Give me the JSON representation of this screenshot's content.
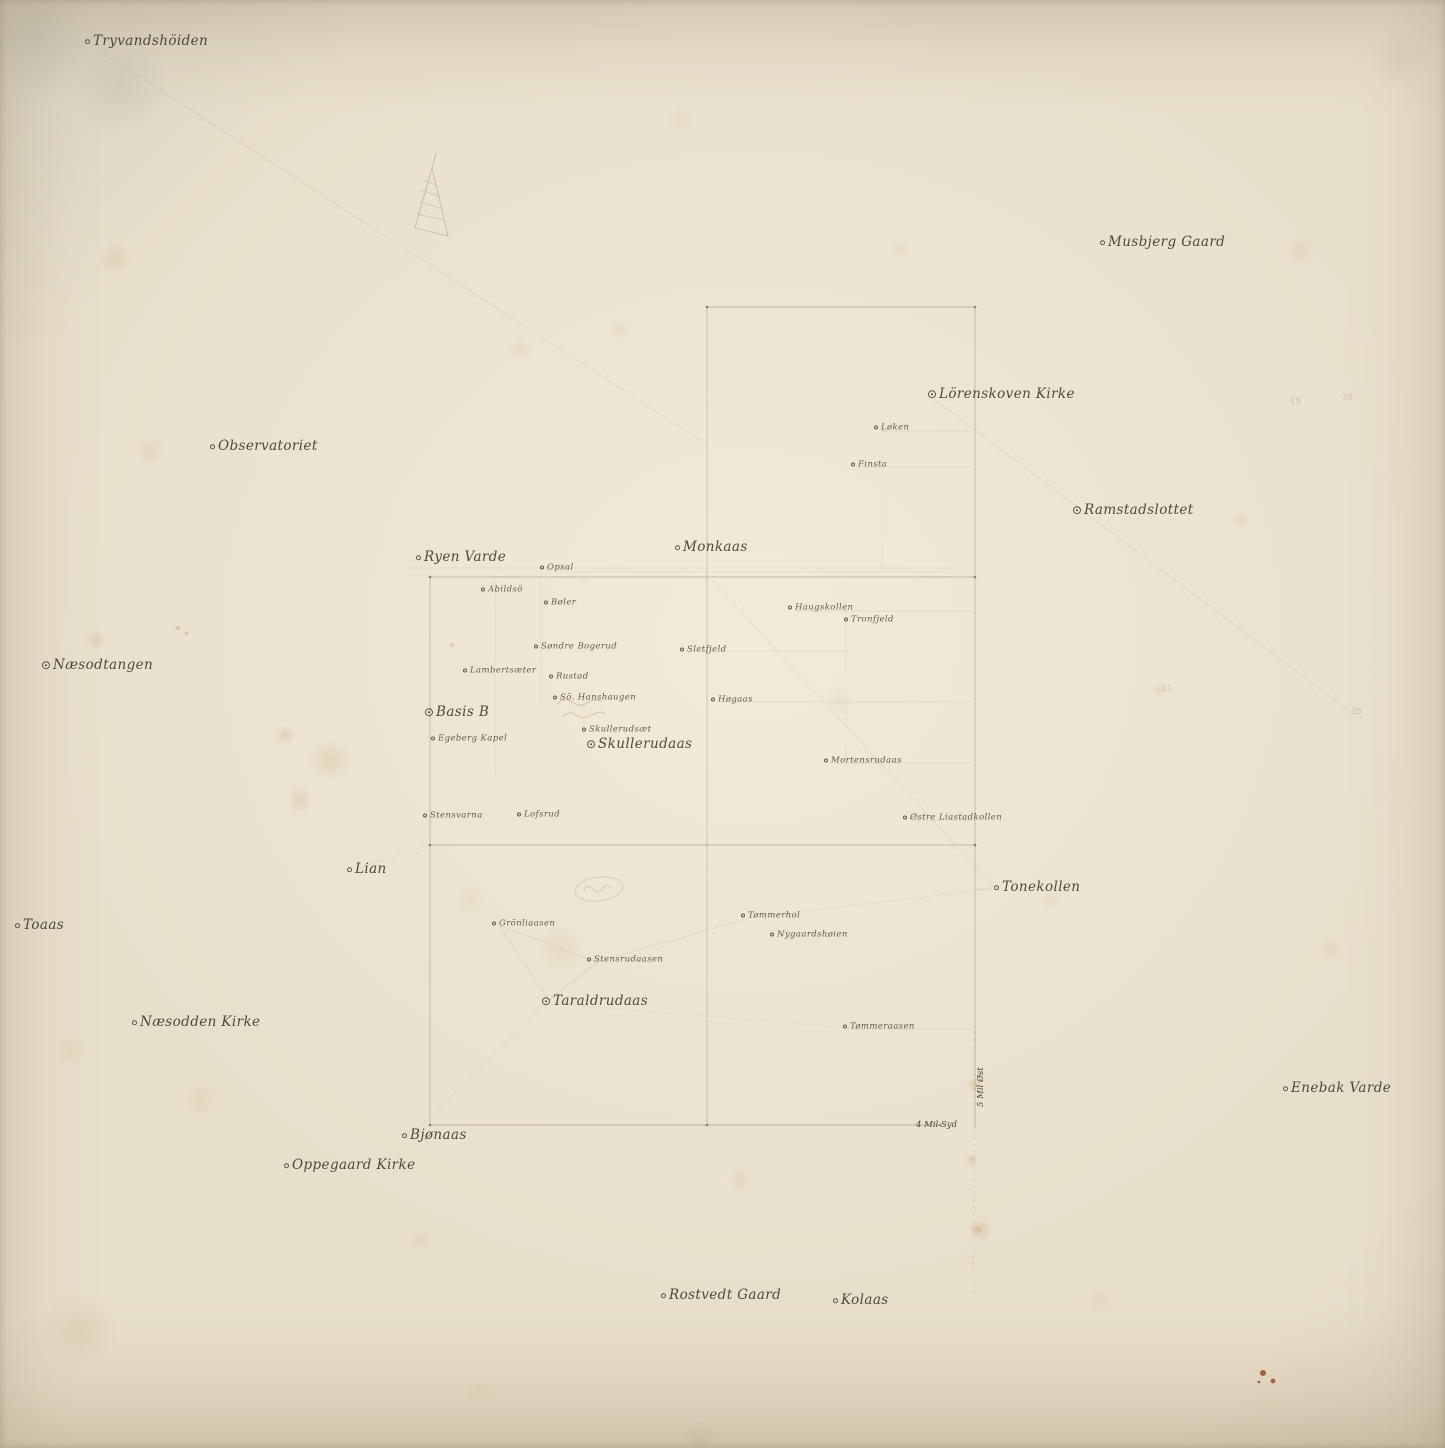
{
  "map": {
    "title": "Triangulation sketch map (Kristiania / Oslo environs)",
    "ink_color": "#3a3326",
    "pencil_color": "#9a8c72",
    "paper_color": "#e8dfcb",
    "stations": [
      {
        "id": "tryvandshoiden",
        "name": "Tryvandshöiden",
        "x": 88,
        "y": 42,
        "size": "major",
        "marker": "single"
      },
      {
        "id": "musbjerg-gaard",
        "name": "Musbjerg Gaard",
        "x": 1103,
        "y": 243,
        "size": "major",
        "marker": "single"
      },
      {
        "id": "lorenskoven-kirke",
        "name": "Lörenskoven Kirke",
        "x": 931,
        "y": 395,
        "size": "major",
        "marker": "double"
      },
      {
        "id": "loken",
        "name": "Løken",
        "x": 877,
        "y": 428,
        "size": "minor",
        "marker": "single"
      },
      {
        "id": "finsta",
        "name": "Finsta",
        "x": 854,
        "y": 465,
        "size": "minor",
        "marker": "single"
      },
      {
        "id": "observatoriet",
        "name": "Observatoriet",
        "x": 213,
        "y": 447,
        "size": "major",
        "marker": "single"
      },
      {
        "id": "ramstadslottet",
        "name": "Ramstadslottet",
        "x": 1076,
        "y": 511,
        "size": "major",
        "marker": "double"
      },
      {
        "id": "monkaas",
        "name": "Monkaas",
        "x": 678,
        "y": 548,
        "size": "major",
        "marker": "single"
      },
      {
        "id": "ryen-varde",
        "name": "Ryen Varde",
        "x": 419,
        "y": 558,
        "size": "major",
        "marker": "single"
      },
      {
        "id": "opsal",
        "name": "Opsal",
        "x": 543,
        "y": 568,
        "size": "minor",
        "marker": "single"
      },
      {
        "id": "abildso",
        "name": "Abildsö",
        "x": 484,
        "y": 590,
        "size": "minor",
        "marker": "single"
      },
      {
        "id": "boler",
        "name": "Bøler",
        "x": 547,
        "y": 603,
        "size": "minor",
        "marker": "single"
      },
      {
        "id": "haugskollen",
        "name": "Haugskollen",
        "x": 791,
        "y": 608,
        "size": "minor",
        "marker": "single"
      },
      {
        "id": "tronfjeld",
        "name": "Tronfjeld",
        "x": 847,
        "y": 620,
        "size": "minor",
        "marker": "single"
      },
      {
        "id": "sondre-bogerud",
        "name": "Søndre Bogerud",
        "x": 537,
        "y": 647,
        "size": "minor",
        "marker": "single"
      },
      {
        "id": "sletfjeld",
        "name": "Sletfjeld",
        "x": 683,
        "y": 650,
        "size": "minor",
        "marker": "single"
      },
      {
        "id": "naesodtangen",
        "name": "Næsodtangen",
        "x": 45,
        "y": 666,
        "size": "major",
        "marker": "double"
      },
      {
        "id": "lambertsaeter",
        "name": "Lambertsæter",
        "x": 466,
        "y": 671,
        "size": "minor",
        "marker": "single"
      },
      {
        "id": "rustad",
        "name": "Rustad",
        "x": 552,
        "y": 677,
        "size": "minor",
        "marker": "single"
      },
      {
        "id": "so-hanshaugen",
        "name": "Sö. Hanshaugen",
        "x": 556,
        "y": 698,
        "size": "minor",
        "marker": "single"
      },
      {
        "id": "hogaas",
        "name": "Høgaas",
        "x": 714,
        "y": 700,
        "size": "minor",
        "marker": "single"
      },
      {
        "id": "basis-b",
        "name": "Basis B",
        "x": 428,
        "y": 713,
        "size": "major",
        "marker": "double"
      },
      {
        "id": "skullerudsaet",
        "name": "Skullerudsæt",
        "x": 585,
        "y": 730,
        "size": "minor",
        "marker": "single"
      },
      {
        "id": "egeberg-kapel",
        "name": "Egeberg Kapel",
        "x": 434,
        "y": 739,
        "size": "minor",
        "marker": "single"
      },
      {
        "id": "skullerudaas",
        "name": "Skullerudaas",
        "x": 590,
        "y": 745,
        "size": "major",
        "marker": "double"
      },
      {
        "id": "mortensrudaas",
        "name": "Mortensrudaas",
        "x": 827,
        "y": 761,
        "size": "minor",
        "marker": "single"
      },
      {
        "id": "stensvarna",
        "name": "Stensvarna",
        "x": 426,
        "y": 816,
        "size": "minor",
        "marker": "single"
      },
      {
        "id": "lofsrud",
        "name": "Lofsrud",
        "x": 520,
        "y": 815,
        "size": "minor",
        "marker": "single"
      },
      {
        "id": "ostre-liastadkollen",
        "name": "Østre Liastadkollen",
        "x": 906,
        "y": 818,
        "size": "minor",
        "marker": "single"
      },
      {
        "id": "lian",
        "name": "Lian",
        "x": 350,
        "y": 870,
        "size": "major",
        "marker": "single"
      },
      {
        "id": "tonekollen",
        "name": "Tonekollen",
        "x": 997,
        "y": 888,
        "size": "major",
        "marker": "single"
      },
      {
        "id": "tommerhol",
        "name": "Tømmerhol",
        "x": 744,
        "y": 916,
        "size": "minor",
        "marker": "single"
      },
      {
        "id": "toaas",
        "name": "Toaas",
        "x": 18,
        "y": 926,
        "size": "major",
        "marker": "single"
      },
      {
        "id": "gronliaasen",
        "name": "Grönliaasen",
        "x": 495,
        "y": 924,
        "size": "minor",
        "marker": "single"
      },
      {
        "id": "nygaardshoien",
        "name": "Nygaardshøien",
        "x": 773,
        "y": 935,
        "size": "minor",
        "marker": "single"
      },
      {
        "id": "stensrudaasen",
        "name": "Stensrudaasen",
        "x": 590,
        "y": 960,
        "size": "minor",
        "marker": "single"
      },
      {
        "id": "taraldrudaas",
        "name": "Taraldrudaas",
        "x": 545,
        "y": 1002,
        "size": "major",
        "marker": "double"
      },
      {
        "id": "naesodden-kirke",
        "name": "Næsodden Kirke",
        "x": 135,
        "y": 1023,
        "size": "major",
        "marker": "single"
      },
      {
        "id": "tommeraasen",
        "name": "Tømmeraasen",
        "x": 846,
        "y": 1027,
        "size": "minor",
        "marker": "single"
      },
      {
        "id": "enebak-varde",
        "name": "Enebak Varde",
        "x": 1286,
        "y": 1089,
        "size": "major",
        "marker": "single"
      },
      {
        "id": "bjonaas",
        "name": "Bjønaas",
        "x": 405,
        "y": 1136,
        "size": "major",
        "marker": "single"
      },
      {
        "id": "oppegaard-kirke",
        "name": "Oppegaard Kirke",
        "x": 287,
        "y": 1166,
        "size": "major",
        "marker": "single"
      },
      {
        "id": "rostvedt-gaard",
        "name": "Rostvedt Gaard",
        "x": 664,
        "y": 1296,
        "size": "major",
        "marker": "single"
      },
      {
        "id": "kolaas",
        "name": "Kolaas",
        "x": 836,
        "y": 1301,
        "size": "major",
        "marker": "single"
      }
    ],
    "annotations": [
      {
        "id": "mil-ost",
        "text": "5 Mil Øst",
        "x": 981,
        "y": 1102,
        "style": "ink",
        "vertical": true
      },
      {
        "id": "mil-syd",
        "text": "4 Mil Syd",
        "x": 918,
        "y": 1125,
        "style": "ink",
        "vertical": false
      },
      {
        "id": "pencil-15",
        "text": "15",
        "x": 1292,
        "y": 402,
        "style": "pencil",
        "vertical": false,
        "opacity": 0.3
      },
      {
        "id": "pencil-39",
        "text": "39",
        "x": 1344,
        "y": 398,
        "style": "pencil",
        "vertical": false,
        "opacity": 0.3
      },
      {
        "id": "pencil-11",
        "text": "11",
        "x": 1163,
        "y": 689,
        "style": "pencil",
        "vertical": false,
        "opacity": 0.25
      },
      {
        "id": "pencil-35",
        "text": "35",
        "x": 1353,
        "y": 712,
        "style": "pencil",
        "vertical": false,
        "opacity": 0.32
      }
    ],
    "lines": [
      {
        "x1": 707,
        "y1": 307,
        "x2": 975,
        "y2": 307,
        "o": 0.5,
        "w": 0.7
      },
      {
        "x1": 975,
        "y1": 307,
        "x2": 975,
        "y2": 1128,
        "o": 0.45,
        "w": 0.7
      },
      {
        "x1": 707,
        "y1": 307,
        "x2": 707,
        "y2": 1125,
        "o": 0.38,
        "w": 0.7
      },
      {
        "x1": 430,
        "y1": 577,
        "x2": 975,
        "y2": 577,
        "o": 0.5,
        "w": 0.7
      },
      {
        "x1": 430,
        "y1": 577,
        "x2": 430,
        "y2": 1125,
        "o": 0.45,
        "w": 0.7
      },
      {
        "x1": 430,
        "y1": 845,
        "x2": 975,
        "y2": 845,
        "o": 0.45,
        "w": 0.7
      },
      {
        "x1": 430,
        "y1": 1125,
        "x2": 940,
        "y2": 1125,
        "o": 0.5,
        "w": 0.7
      },
      {
        "x1": 410,
        "y1": 568,
        "x2": 952,
        "y2": 568,
        "o": 0.18,
        "w": 0.6
      },
      {
        "x1": 560,
        "y1": 572,
        "x2": 948,
        "y2": 572,
        "o": 0.15,
        "w": 0.5
      },
      {
        "x1": 882,
        "y1": 431,
        "x2": 972,
        "y2": 431,
        "o": 0.2,
        "w": 0.5
      },
      {
        "x1": 862,
        "y1": 467,
        "x2": 972,
        "y2": 467,
        "o": 0.2,
        "w": 0.5
      },
      {
        "x1": 795,
        "y1": 611,
        "x2": 972,
        "y2": 611,
        "o": 0.2,
        "w": 0.5
      },
      {
        "x1": 690,
        "y1": 651,
        "x2": 848,
        "y2": 651,
        "o": 0.18,
        "w": 0.5
      },
      {
        "x1": 720,
        "y1": 702,
        "x2": 972,
        "y2": 702,
        "o": 0.2,
        "w": 0.5
      },
      {
        "x1": 834,
        "y1": 763,
        "x2": 972,
        "y2": 763,
        "o": 0.2,
        "w": 0.5
      },
      {
        "x1": 914,
        "y1": 820,
        "x2": 972,
        "y2": 820,
        "o": 0.2,
        "w": 0.5
      },
      {
        "x1": 975,
        "y1": 889,
        "x2": 993,
        "y2": 889,
        "o": 0.22,
        "w": 0.5
      },
      {
        "x1": 854,
        "y1": 1029,
        "x2": 972,
        "y2": 1029,
        "o": 0.2,
        "w": 0.5
      },
      {
        "x1": 495,
        "y1": 580,
        "x2": 495,
        "y2": 775,
        "o": 0.14,
        "w": 0.5
      },
      {
        "x1": 541,
        "y1": 570,
        "x2": 541,
        "y2": 705,
        "o": 0.13,
        "w": 0.5
      },
      {
        "x1": 584,
        "y1": 575,
        "x2": 584,
        "y2": 737,
        "o": 0.13,
        "w": 0.5
      },
      {
        "x1": 846,
        "y1": 582,
        "x2": 846,
        "y2": 768,
        "o": 0.12,
        "w": 0.5
      },
      {
        "x1": 882,
        "y1": 420,
        "x2": 882,
        "y2": 575,
        "o": 0.12,
        "w": 0.5
      },
      {
        "x1": 95,
        "y1": 48,
        "x2": 705,
        "y2": 443,
        "o": 0.15,
        "w": 0.6
      },
      {
        "x1": 935,
        "y1": 400,
        "x2": 1352,
        "y2": 713,
        "o": 0.15,
        "w": 0.6
      },
      {
        "x1": 712,
        "y1": 580,
        "x2": 993,
        "y2": 886,
        "o": 0.13,
        "w": 0.6
      },
      {
        "x1": 357,
        "y1": 869,
        "x2": 428,
        "y2": 845,
        "o": 0.15,
        "w": 0.6
      },
      {
        "x1": 549,
        "y1": 1000,
        "x2": 598,
        "y2": 962,
        "o": 0.2,
        "w": 0.6
      },
      {
        "x1": 598,
        "y1": 962,
        "x2": 500,
        "y2": 926,
        "o": 0.18,
        "w": 0.6
      },
      {
        "x1": 549,
        "y1": 1000,
        "x2": 500,
        "y2": 927,
        "o": 0.16,
        "w": 0.6
      },
      {
        "x1": 598,
        "y1": 962,
        "x2": 748,
        "y2": 918,
        "o": 0.16,
        "w": 0.6
      },
      {
        "x1": 748,
        "y1": 918,
        "x2": 990,
        "y2": 889,
        "o": 0.12,
        "w": 0.5
      },
      {
        "x1": 549,
        "y1": 1003,
        "x2": 850,
        "y2": 1028,
        "o": 0.1,
        "w": 0.5
      },
      {
        "x1": 545,
        "y1": 1005,
        "x2": 413,
        "y2": 1133,
        "o": 0.1,
        "w": 0.5
      }
    ]
  }
}
